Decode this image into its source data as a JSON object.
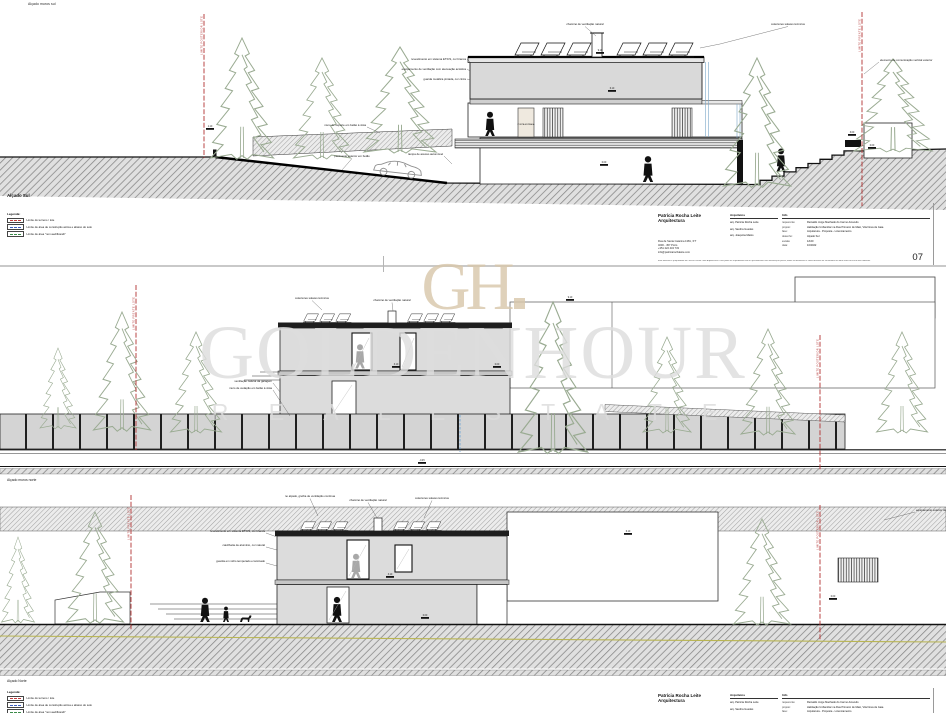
{
  "captions": {
    "sheet1_top": "Alçado muros sul",
    "sheet1": "Alçado Sul",
    "sheet2": "Alçado muros norte",
    "sheet3": "Alçado Norte"
  },
  "legend": {
    "title": "Legenda:",
    "items": [
      "Limite do terreno / lote",
      "Limite de área de construção acima e abaixo do solo",
      "Limite de área \"non aedificandi\""
    ]
  },
  "boundaries": {
    "rear": "LIMITE POSTERIOR LOTE",
    "front": "LIMITE FRENTE LOTE"
  },
  "title_block": {
    "firm_line1": "Patrícia Rocha Leite",
    "firm_line2": "Arquitectura",
    "address": [
      "Rua de Santa Catarina 1381, 3ºT",
      "4000 - 457 Porto",
      "+351 222 434 733",
      "info@patriciarochaleite.com"
    ],
    "architects_header": "Arquitetos",
    "architects": [
      "arq. Patrícia Rocha Leite",
      "arq. Sandra Guedes",
      "arq. Joaquina Matos"
    ],
    "info_header": "Info",
    "info": [
      {
        "k": "requerente:",
        "v": "Reinaldo Jorge Machado do Carmo Azevedo"
      },
      {
        "k": "projeto:",
        "v": "Habitação Unifamiliar na Rua Primeiro de Maio, Vila Nova de Gaia"
      },
      {
        "k": "fase:",
        "v": "Arquitetura - Proposta - Licenciamento"
      },
      {
        "k": "desenho:",
        "v": "Alçado Sul"
      },
      {
        "k": "escala:",
        "v": "1/100"
      },
      {
        "k": "data:",
        "v": "10/2022"
      }
    ],
    "sheet_number": "07",
    "disclaimer": "Este desenho é propriedade de Patrícia Rocha Leite Arquitectura e não pode ser reproduzido total ou parcialmente sem autorização prévia; todas as dimensões e cotas deverão ser verificadas em obra antes do início dos trabalhos."
  },
  "watermark": {
    "logo": "GH",
    "brand": "GOLDENHOUR",
    "tagline": "R E A L   E S T A T E"
  },
  "annotations": {
    "d1": [
      "colectores solares térmicos",
      "chaminé de ventilação natural",
      "equipamento de ventilação com atenuação acústica",
      "elemento de comunicação vertical exterior",
      "revestimento em sistema ETICS, cor branca",
      "muro de suporte em betão à vista",
      "guarda metálica pintada, cor cinza",
      "PORTA ENTRADA",
      "pavimento exterior em betão",
      "rampa de acesso automóvel"
    ],
    "d2": [
      "colectores solares térmicos",
      "chaminé de ventilação natural",
      "ventilação natural da garagem",
      "muro de vedação em betão à vista"
    ],
    "d3": [
      "no alçado, grelha de ventilação contínua",
      "revestimento em sistema ETICS, cor branca",
      "caixilharia de alumínio, cor natural",
      "guarda em vidro temperado e laminado",
      "colectores solares térmicos",
      "chaminé de ventilação natural",
      "equipamento exterior de climatização"
    ],
    "levels": [
      "9.10",
      "6.10",
      "3.10",
      "1.10",
      "0.00",
      "-0.45",
      "3.00"
    ]
  },
  "colors": {
    "boundary_red": "#b23232",
    "tree_green": "#9aab92",
    "watermark_beige": "#d8c7ab",
    "watermark_grey": "#dedede",
    "pipe_blue": "#7aa7c8"
  }
}
